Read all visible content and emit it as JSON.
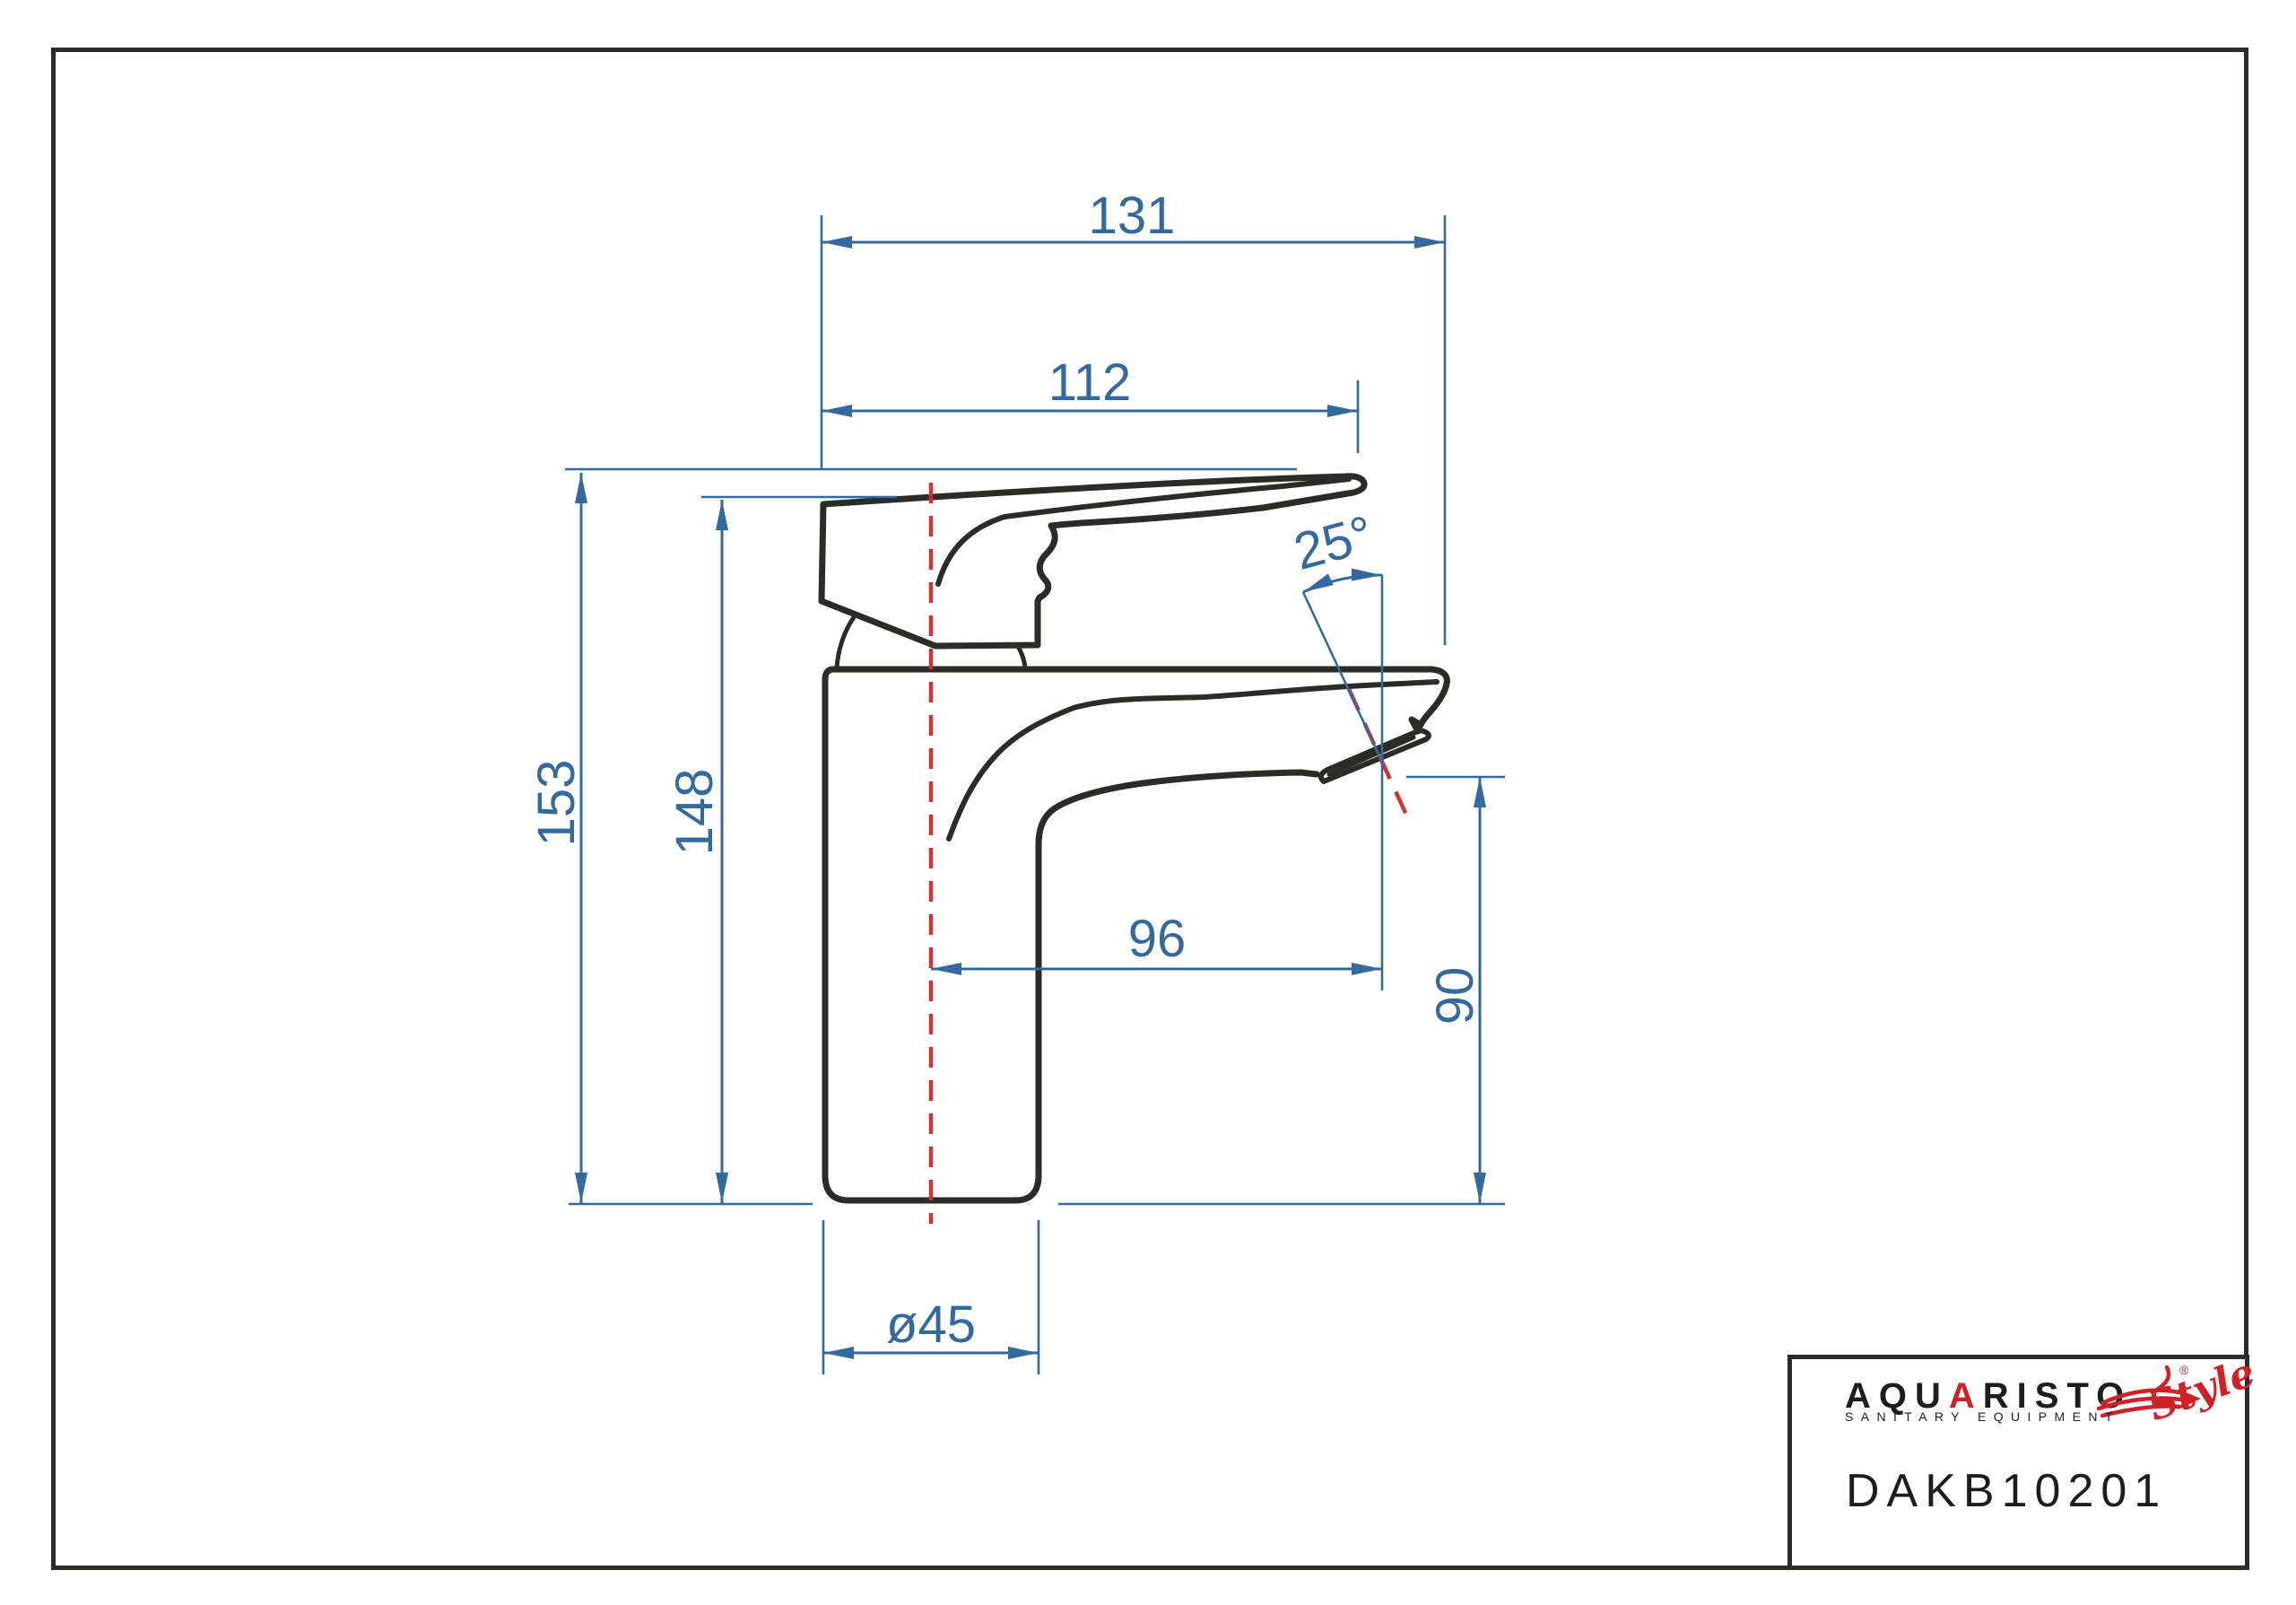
{
  "page": {
    "background": "#ffffff"
  },
  "drawing": {
    "type": "technical-dimension-drawing",
    "subject": "single-lever basin mixer tap, side view",
    "colors": {
      "outline": "#2b2b28",
      "dimension": "#34699e",
      "centerline": "#cc3333"
    },
    "labels": {
      "overall_width": "131",
      "handle_width": "112",
      "total_height": "153",
      "body_height": "148",
      "spout_reach": "96",
      "outlet_height": "90",
      "outlet_angle": "25°",
      "base_diameter": "ø45"
    }
  },
  "title_block": {
    "brand_prefix": "AQU",
    "brand_accent": "A",
    "brand_suffix": "RISTO",
    "registered_mark": "®",
    "tagline": "SANITARY EQUIPMENT",
    "style_script": "Style",
    "model_code": "DAKB10201",
    "accent_color": "#d02028",
    "text_color": "#1d1d1b"
  }
}
